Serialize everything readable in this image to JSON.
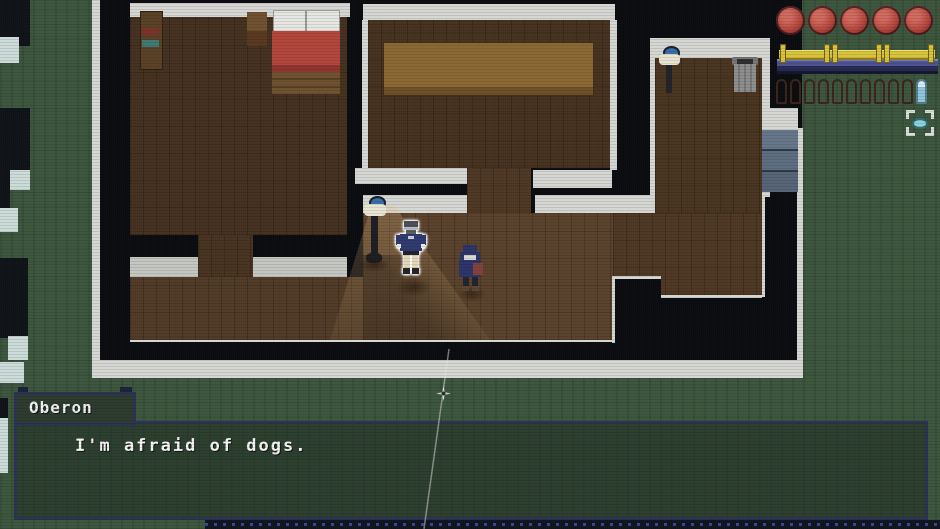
{
  "dialogue": {
    "speaker": "Oberon",
    "text": "I'm afraid of dogs."
  },
  "hud": {
    "health": {
      "orbs": 5,
      "orb_color": "#b2453a"
    },
    "fence_bar": {
      "segments": 3,
      "fence_color": "#d9c33c",
      "bar_color": "#4d5290"
    },
    "ammo": {
      "empty_slots": 10,
      "filled_slots": 1,
      "filled_color": "#8fc6db"
    },
    "target_icon": "focus-brackets-icon"
  },
  "scene": {
    "characters": [
      {
        "id": "player",
        "description": "outlined figure, navy shirt, tan pants, hands on hips"
      },
      {
        "id": "npc-hooded",
        "description": "navy hooded figure with red satchel"
      }
    ],
    "furniture": [
      "bed",
      "bookshelf",
      "nightstand",
      "long-table",
      "lamp-hall",
      "lamp-room",
      "trash-can",
      "stairs"
    ],
    "colors": {
      "grass": "#3d563e",
      "house_interior": "#0b0c10",
      "walls": "#d6d6d3",
      "wood_floor": "#4e3823",
      "dialog_border": "#2b3252"
    }
  }
}
